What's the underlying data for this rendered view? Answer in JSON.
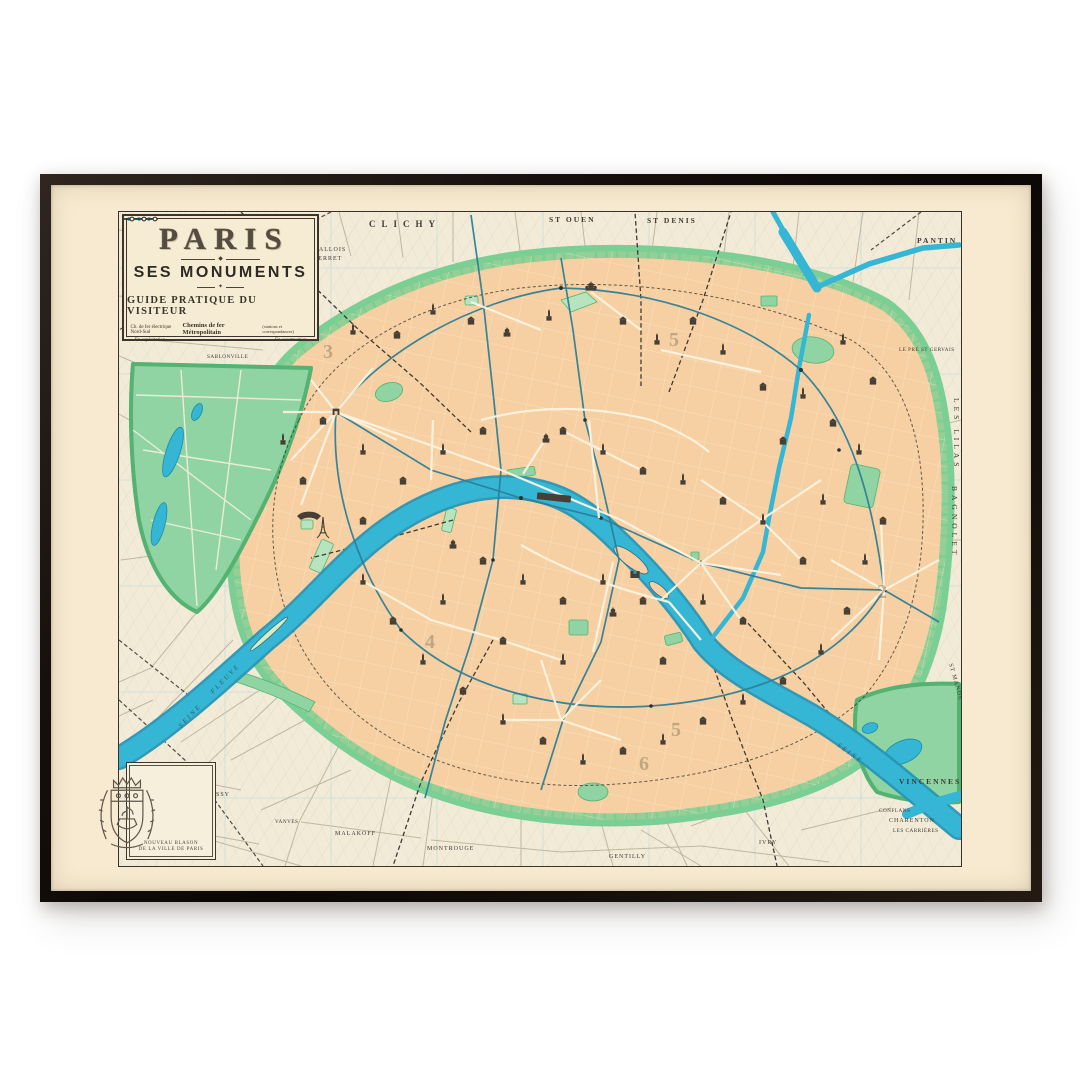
{
  "artwork": {
    "title": "PARIS",
    "subtitle": "SES MONUMENTS",
    "tagline": "GUIDE PRATIQUE DU VISITEUR",
    "legend": {
      "electric": "Ch. de fer électrique Nord-Sud",
      "metro": "Chemins de fer Métropolitain",
      "metro_note": "(stations et correspondances)",
      "in_service": "En exploitation",
      "in_construction": "En construction"
    },
    "blason": {
      "caption_line1": "NOUVEAU BLASON",
      "caption_line2": "DE LA VILLE DE PARIS"
    }
  },
  "map_labels": {
    "clichy": "CLICHY",
    "st_ouen": "ST OUEN",
    "st_denis": "ST DENIS",
    "pantin": "PANTIN",
    "levallois_l1": "LEVALLOIS",
    "levallois_l2": "-PERRET",
    "champerret": "CHAMPERRET",
    "sablonville": "SABLONVILLE",
    "le_pre_st_gervais": "LE PRÉ ST GERVAIS",
    "les_lilas": "LES LILAS",
    "bagnolet": "BAGNOLET",
    "st_mande": "ST MANDÉ",
    "vincennes": "VINCENNES",
    "conflans": "CONFLANS",
    "charenton": "CHARENTON",
    "les_carrieres": "LES CARRIÈRES",
    "ivry": "IVRY",
    "gentilly": "GENTILLY",
    "montrouge": "MONTROUGE",
    "malakoff": "MALAKOFF",
    "vanves": "VANVES",
    "issy": "ISSY",
    "fleuve": "FLEUVE",
    "seine_sw": "SEINE",
    "seine_se": "SEINE"
  },
  "plate_numbers": {
    "n1": "3",
    "n2": "5",
    "n3": "2",
    "n4": "5",
    "n5": "6",
    "n6": "4"
  },
  "palette": {
    "frame": "#16100c",
    "mat": "#f7ead0",
    "paper": "#f2ebd7",
    "city": "#f6d0a2",
    "park": "#8fd4a2",
    "fortification": "#6cc488",
    "water": "#35b6d4",
    "metro": "#2d7f97",
    "ink": "#3f3a33"
  }
}
